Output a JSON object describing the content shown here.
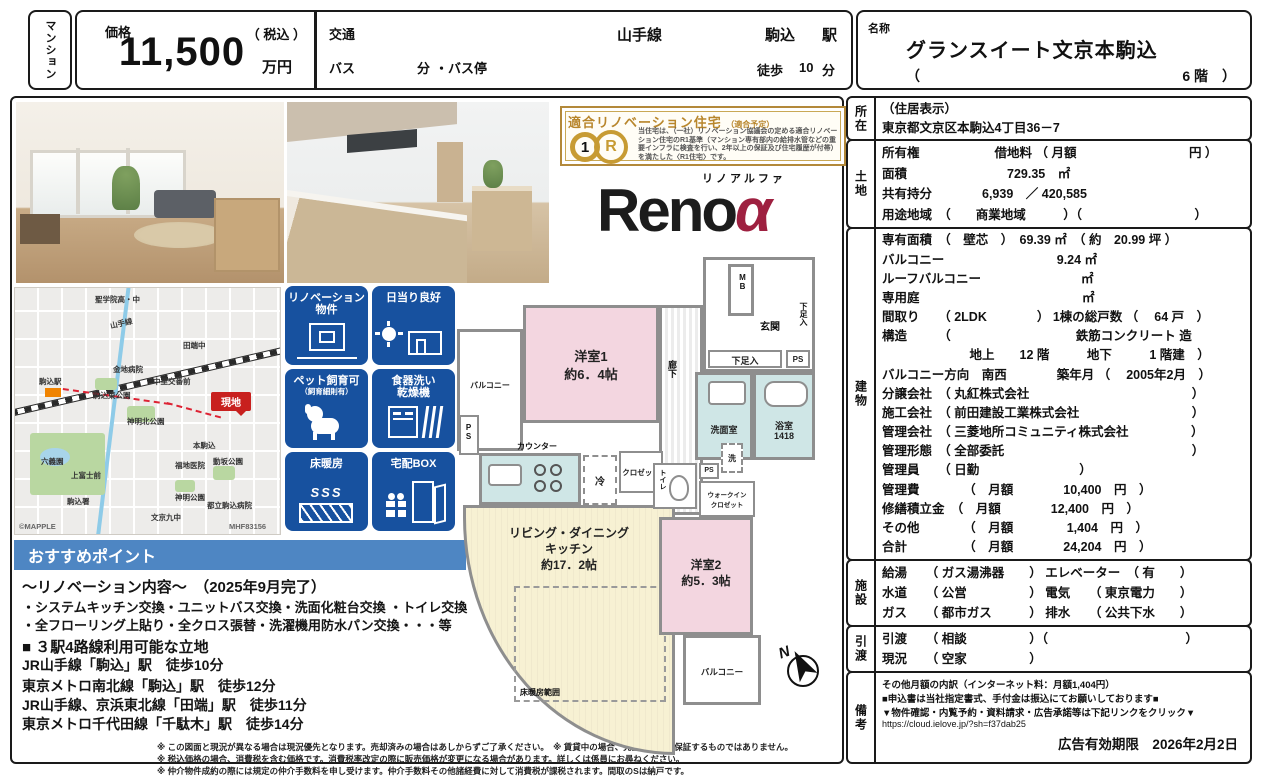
{
  "header": {
    "property_type": "マンション",
    "price": {
      "label": "価格",
      "value": "11,500",
      "tax_note": "（ 税込 ）",
      "unit": "万円"
    },
    "access": {
      "label": "交通",
      "line": "山手線",
      "station": "駒込",
      "station_suffix": "駅",
      "bus_label": "バス",
      "bus_min": "分",
      "bus_stop": "・バス停",
      "walk": "徒歩",
      "walk_min": "10",
      "walk_unit": "分"
    },
    "name": {
      "label": "名称",
      "value": "グランスイート文京本駒込",
      "floor_open": "（",
      "floor_value": "6 階　）"
    }
  },
  "cert_seal": {
    "title": "適合リノベーション住宅",
    "subtitle": "（適合予定）",
    "logo_1": "1",
    "logo_r": "R",
    "body": "当住宅は、（一社）リノベーション協議会の定める適合リノベーション住宅のR1基準（マンション専有部内の給排水管などの重要インフラに検査を行い、2年以上の保証及び住宅履歴が付帯）を満たした〈R1住宅〉です。"
  },
  "reno_logo": {
    "furigana": "リノアルファ",
    "text": "Reno",
    "alpha": "α"
  },
  "map": {
    "labels": [
      "聖学院高・中",
      "山手線",
      "駒込駅",
      "田端中",
      "金地病院",
      "中里交番前",
      "駒込東公園",
      "神明北公園",
      "六義園",
      "上富士前",
      "本駒込",
      "福地医院",
      "神明公園",
      "動坂公園",
      "文京九中",
      "都立駒込病院",
      "駒込署"
    ],
    "site_label": "現地",
    "credit": "©MAPPLE",
    "code": "MHF83156"
  },
  "badges": [
    {
      "line1": "リノベーション",
      "line2": "物件"
    },
    {
      "line1": "日当り良好",
      "line2": ""
    },
    {
      "line1": "ペット飼育可",
      "line2": "（飼育細則有）"
    },
    {
      "line1": "食器洗い",
      "line2": "乾燥機"
    },
    {
      "line1": "床暖房",
      "line2": ""
    },
    {
      "line1": "宅配BOX",
      "line2": ""
    }
  ],
  "points": {
    "title": "おすすめポイント",
    "lines": [
      "～リノベーション内容～　（2025年9月完了）",
      "・システムキッチン交換・ユニットバス交換・洗面化粧台交換 ・トイレ交換",
      "・全フローリング上貼り・全クロス張替・洗濯機用防水パン交換・・・等",
      "■ ３駅4路線利用可能な立地",
      "JR山手線「駒込」駅　徒歩10分",
      "東京メトロ南北線「駒込」駅　徒歩12分",
      "JR山手線、京浜東北線「田端」駅　徒歩11分",
      "東京メトロ千代田線「千駄木」駅　徒歩14分"
    ]
  },
  "floor_plan": {
    "balcony1": "バルコニー",
    "room1_l1": "洋室1",
    "room1_l2": "約6．4帖",
    "hall": "廊下",
    "mb": "MB",
    "genkan": "玄関",
    "geta_v": "下足入",
    "geta_h": "下足入",
    "ps1": "PS",
    "ps2": "PS",
    "ps3": "PS",
    "senmen": "洗面室",
    "bath_l1": "浴室",
    "bath_l2": "1418",
    "counter": "カウンター",
    "rei": "冷",
    "closet": "クロゼット",
    "wash": "洗",
    "toilet": "トイレ",
    "wic_l1": "ウォークイン",
    "wic_l2": "クロゼット",
    "ldk_l1": "リビング・ダイニング",
    "ldk_l2": "キッチン",
    "ldk_l3": "約17．2帖",
    "floor_heat": "床暖房範囲",
    "room2_l1": "洋室2",
    "room2_l2": "約5．3帖",
    "balcony2": "バルコニー",
    "compass_n": "N"
  },
  "details": {
    "sections": [
      {
        "side": "所在",
        "rows": [
          "（住居表示）",
          "東京都文京区本駒込4丁目36－7"
        ]
      },
      {
        "side": "土地",
        "rows": [
          "所有権　　　　　　借地料 （ 月額　　　　　　　　　円 ）",
          "面積　　　　　　　　729.35　㎡",
          "共有持分　　　　6,939　／ 420,585",
          "用途地域　（　　商業地域　　　）（　　　　　　　　　）"
        ]
      },
      {
        "side": "建物",
        "rows": [
          "専有面積　（　壁芯　）　69.39 ㎡　（ 約　20.99 坪 ）",
          "バルコニー　　　　　　　　　9.24 ㎡",
          "ルーフバルコニー　　　　　　　　㎡",
          "専用庭　　　　　　　　　　　　　㎡",
          "間取り　　（ 2LDK　　　　） 1棟の総戸数 （　 64 戸　）",
          "構造　　　（　　　　　　　　　　鉄筋コンクリート 造",
          "　　　　　　　地上　　12 階　　　地下　　　1 階建　）",
          "バルコニー方向　南西　　　　築年月 （　 2005年2月　）",
          "分譲会社　（ 丸紅株式会社　　　　　　　　　　　　　）",
          "施工会社　（ 前田建設工業株式会社　　　　　　　　　）",
          "管理会社　（ 三菱地所コミュニティ株式会社　　　　　）",
          "管理形態　（ 全部委託　　　　　　　　　　　　　　　）",
          "管理員　　（ 日勤　　　　　　　　）",
          "管理費　　　　（　月額　　　　10,400　円　）",
          "修繕積立金　（　月額　　　　12,400　円　）",
          "その他　　　　（　月額　　　　 1,404　円　）",
          "合計　　　　　（　月額　　　　24,204　円　）"
        ]
      },
      {
        "side": "施設",
        "rows": [
          "給湯　　（ ガス湯沸器　　） エレベーター　（ 有　　）",
          "水道　　（ 公営　　　　　） 電気　　（ 東京電力　　）",
          "ガス　　（ 都市ガス　　　） 排水　　（ 公共下水　　）"
        ]
      },
      {
        "side": "引渡",
        "rows": [
          "引渡　　（ 相談　　　　　）（　　　　　　　　　　　）",
          "現況　　（ 空家　　　　　）"
        ]
      },
      {
        "side": "備考",
        "rows": [
          "その他月額の内訳（インターネット料：月額1,404円）",
          "■申込書は当社指定書式、手付金は振込にてお願いしております■",
          "▼物件確認・内覧予約・資料請求・広告承諾等は下記リンクをクリック▼",
          "https://cloud.ielove.jp/?sh=f37dab25"
        ],
        "expiry": "広告有効期限　2026年2月2日"
      }
    ]
  },
  "fine_print": [
    "※ この図面と現況が異なる場合は現況優先となります。売却済みの場合はあしからずご了承ください。　※ 賃貸中の場合、売主が賃料を保証するものではありません。",
    "※ 税込価格の場合、消費税を含む価格です。消費税率改定の際に販売価格が変更になる場合があります。詳しくは係員にお尋ねください。",
    "※ 仲介物件成約の際には規定の仲介手数料を申し受けます。仲介手数料その他諸経費に対して消費税が課税されます。間取のSは納戸です。"
  ]
}
